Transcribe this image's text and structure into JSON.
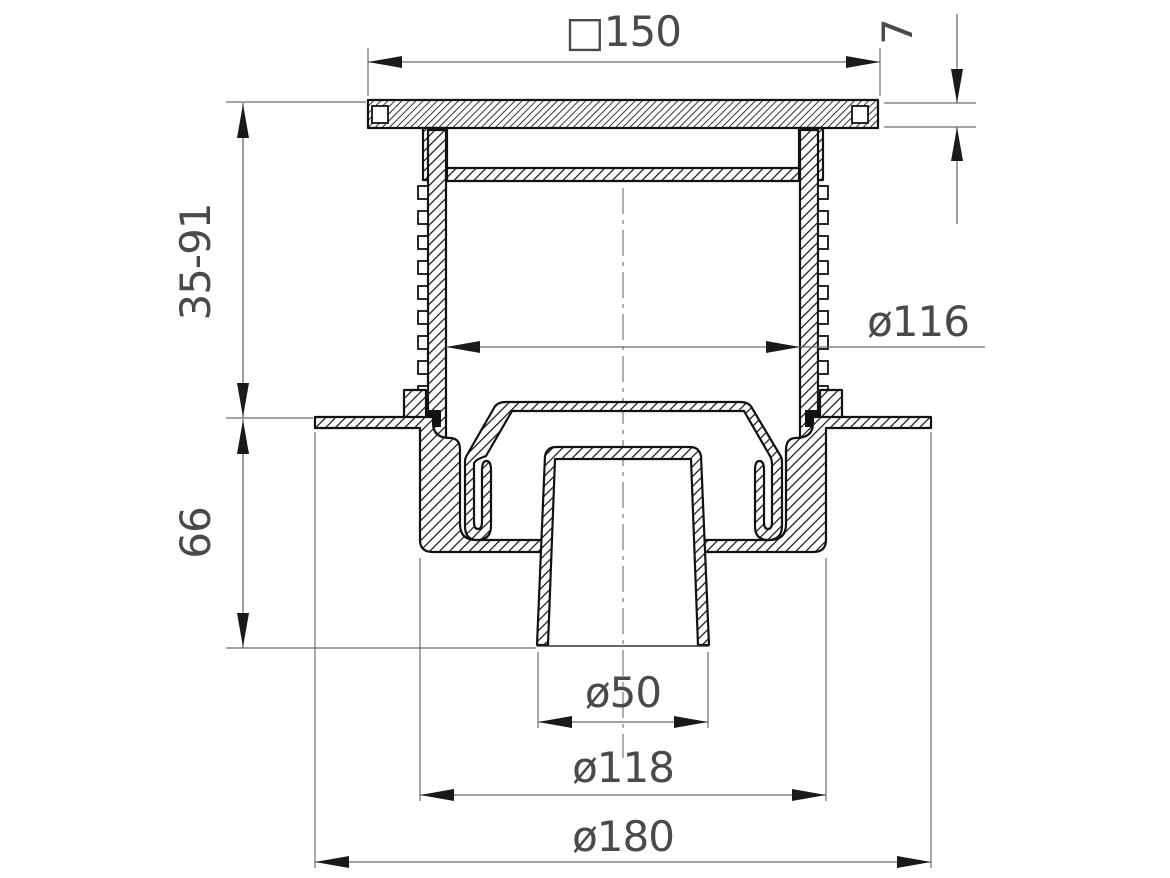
{
  "drawing": {
    "background": "#ffffff",
    "line_color": "#111111",
    "dim_line_color": "#6e6e6e",
    "dim_text_color": "#4a4a4a",
    "dimensions": {
      "top_width": "□150",
      "grate_thickness": "7",
      "adjustable_height": "35-91",
      "riser_inner_diameter": "ø116",
      "trap_height": "66",
      "outlet_diameter": "ø50",
      "body_diameter": "ø118",
      "flange_diameter": "ø180"
    }
  }
}
